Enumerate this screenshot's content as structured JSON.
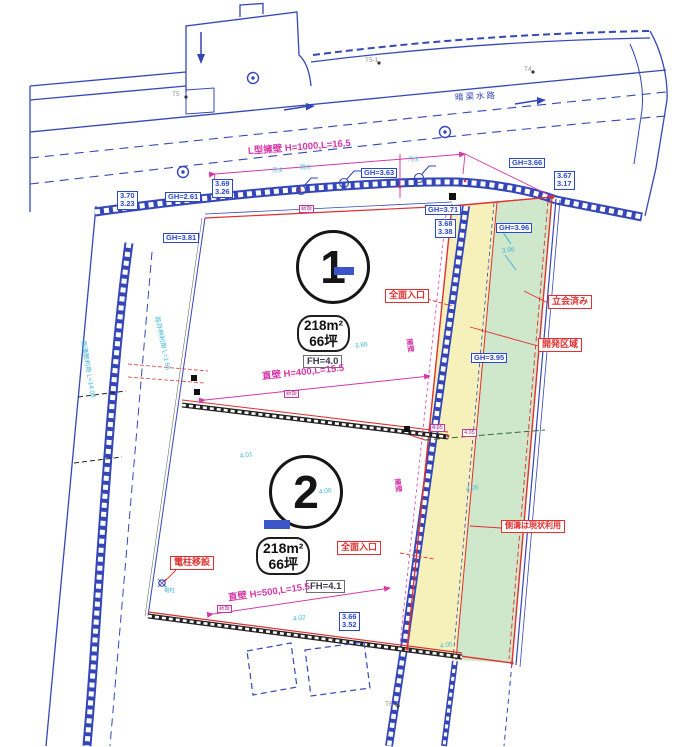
{
  "drawing": {
    "road_label": "暗渠水路",
    "lots": [
      {
        "num": "1",
        "area": "218m²\n66坪",
        "fh": "FH=4.0"
      },
      {
        "num": "2",
        "area": "218m²\n66坪",
        "fh": "FH=4.1"
      }
    ],
    "dims": {
      "top": "L型擁壁 H=1000,L=16.5",
      "mid": "直壁 H=400,L=15.5",
      "bottom": "直壁 H=500,L=15.5",
      "left1": "側溝敷利用 L=14.08",
      "left2": "既存桝利用 L=1.55",
      "wall_note": "擁壁"
    },
    "tags": {
      "entrance1": "全面入口",
      "entrance2": "全面入口",
      "attended": "立会済み",
      "dev": "開発区域",
      "gutter": "側溝は現状利用",
      "pole": "電柱移設",
      "new1": "新設",
      "new2": "新設",
      "new3": "新設",
      "n1": "4.05",
      "n2": "4.05"
    },
    "elev": [
      {
        "v": "3.70\n3.23"
      },
      {
        "v": "GH=2.61"
      },
      {
        "v": "3.69\n3.26"
      },
      {
        "v": "GH=3.81"
      },
      {
        "v": "GH=3.63"
      },
      {
        "v": "GH=3.66"
      },
      {
        "v": "3.67\n3.17"
      },
      {
        "v": "GH=3.71"
      },
      {
        "v": "3.68\n3.38"
      },
      {
        "v": "GH=3.96"
      },
      {
        "v": "GH=3.95"
      },
      {
        "v": "3.66\n3.52"
      }
    ],
    "spots": [
      {
        "v": "3.88"
      },
      {
        "v": "4.01"
      },
      {
        "v": "4.00"
      },
      {
        "v": "4.02"
      },
      {
        "v": "3.96"
      },
      {
        "v": "4.05"
      },
      {
        "v": "4.05"
      }
    ],
    "pits": {
      "p1": "汚水",
      "p2": "雨水",
      "p3": "汚水",
      "pole_spot": "電柱"
    },
    "marks": [
      {
        "t": "T5"
      },
      {
        "t": "T5-1"
      },
      {
        "t": "T4"
      },
      {
        "t": "T6-2"
      }
    ],
    "colors": {
      "blue": "#3547b8",
      "red": "#e03030",
      "magenta": "#d638a8",
      "cyan": "#3fb6dc",
      "yellow": "#f6f1bb",
      "green": "#cfe7cb"
    }
  }
}
